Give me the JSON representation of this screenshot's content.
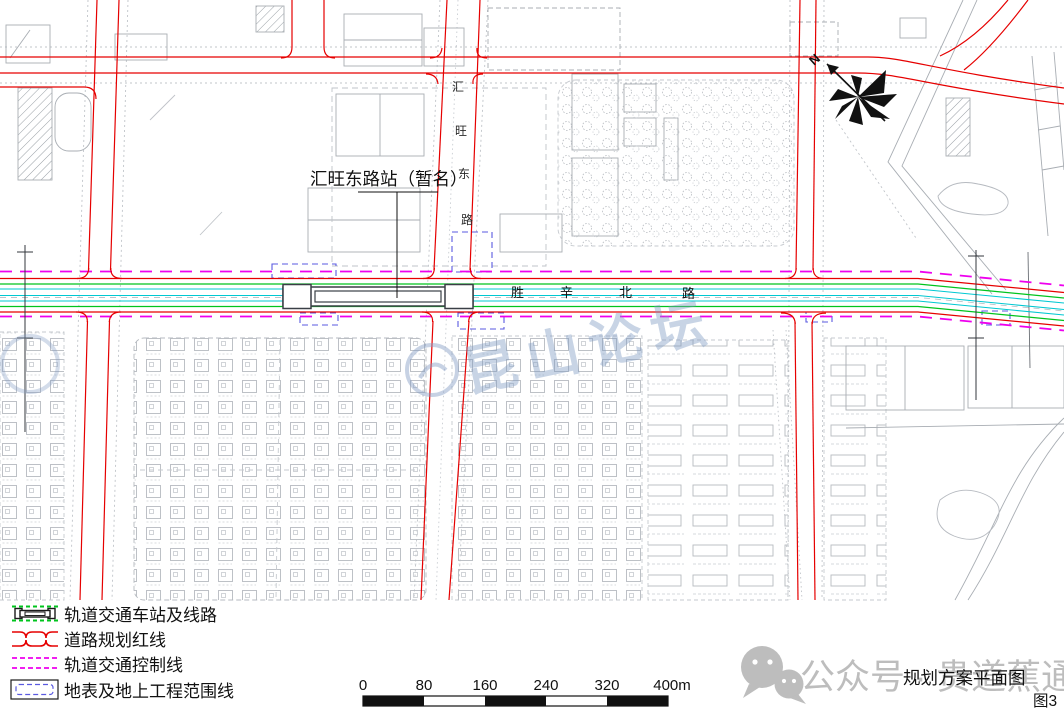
{
  "map": {
    "station_label": "汇旺东路站（暂名）",
    "vertical_road_chars": [
      "汇",
      "旺",
      "东",
      "路"
    ],
    "horizontal_road_chars": [
      "胜",
      "辛",
      "北",
      "路"
    ],
    "north_label": "N",
    "center_watermark": "昆山论坛"
  },
  "legend": {
    "items": [
      {
        "label": "轨道交通车站及线路"
      },
      {
        "label": "道路规划红线"
      },
      {
        "label": "轨道交通控制线"
      },
      {
        "label": "地表及地上工程范围线"
      }
    ]
  },
  "scale_bar": {
    "ticks": [
      "0",
      "80",
      "160",
      "240",
      "320",
      "400m"
    ]
  },
  "footer": {
    "wechat_watermark": "公众号 · 贵道蕉通",
    "drawing_title": "规划方案平面图",
    "figure_label": "图3"
  },
  "colors": {
    "rail_green": "#00c41e",
    "rail_cyan": "#00c8d2",
    "road_red": "#e60000",
    "control_magenta": "#ee00ee",
    "range_blue": "#5a5ae0",
    "linework_gray": "#aab0b6"
  }
}
